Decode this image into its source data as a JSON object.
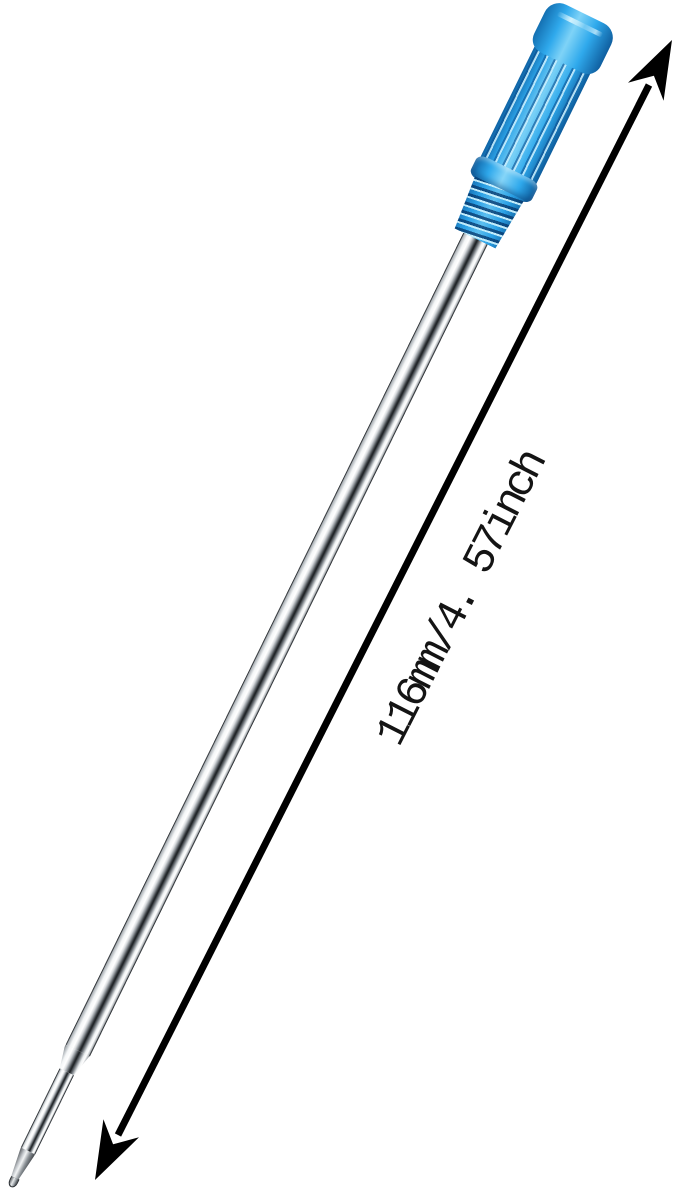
{
  "canvas": {
    "width": 679,
    "height": 1204,
    "background": "#ffffff"
  },
  "annotation": {
    "label": "116mm/4. 57inch",
    "arrow_color": "#000000",
    "text_color": "#141414"
  },
  "product": {
    "name": "ballpoint pen refill",
    "cap_colors": {
      "main": "#2BA7E9",
      "highlight": "#8FD9F9",
      "shadow": "#0F5FA0"
    },
    "barrel_colors": {
      "highlight": "#FFFFFF",
      "mid": "#9AA0A6",
      "shadow": "#1D2124"
    }
  }
}
